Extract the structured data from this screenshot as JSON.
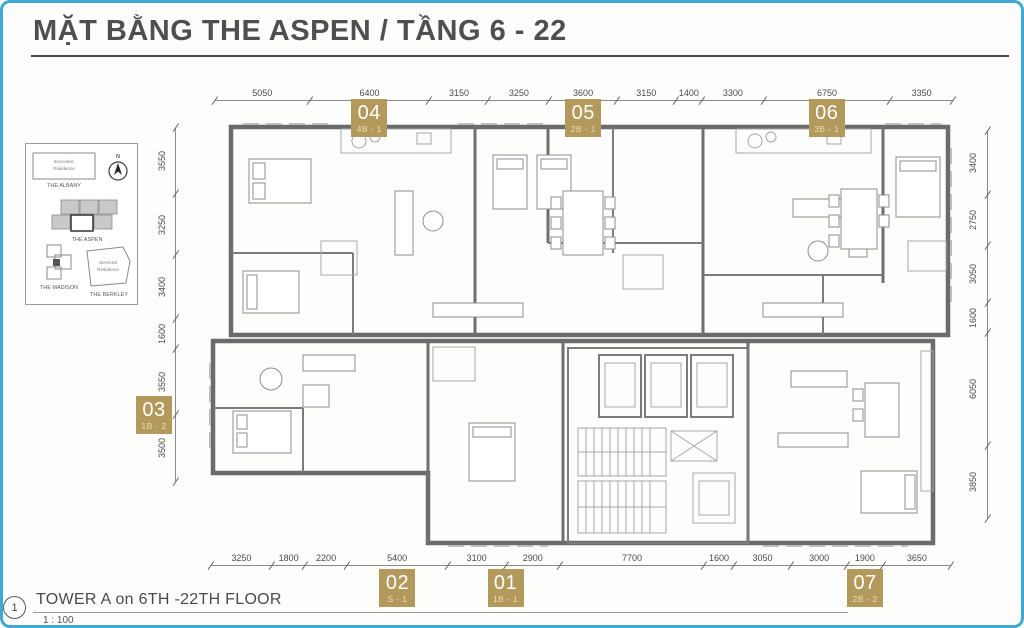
{
  "page": {
    "title": "MẶT BẰNG THE ASPEN / TẦNG 6 - 22",
    "border_color": "#3fa9d5",
    "accent_gold": "#b3995b"
  },
  "key_plan": {
    "compass_label": "N",
    "albany_sub1": "Executive",
    "albany_sub2": "Residence",
    "albany": "THE ALBANY",
    "aspen": "THE ASPEN",
    "madison": "THE MADISON",
    "berkley_sub1": "Serviced",
    "berkley_sub2": "Residence",
    "berkley": "THE BERKLEY"
  },
  "dimensions": {
    "top": [
      5050,
      6400,
      3150,
      3250,
      3600,
      3150,
      1400,
      3300,
      6750,
      3350
    ],
    "bottom": [
      3250,
      1800,
      2200,
      5400,
      3100,
      2900,
      7700,
      1600,
      3050,
      3000,
      1900,
      3650
    ],
    "left": [
      3550,
      3250,
      3400,
      1600,
      3550,
      3500
    ],
    "right": [
      3400,
      2750,
      3050,
      1600,
      6050,
      3850
    ]
  },
  "units": [
    {
      "number": "04",
      "type": "4B - 1",
      "side": "top",
      "pos": 0.209
    },
    {
      "number": "05",
      "type": "2B - 1",
      "side": "top",
      "pos": 0.499
    },
    {
      "number": "06",
      "type": "3B - 1",
      "side": "top",
      "pos": 0.829
    },
    {
      "number": "03",
      "type": "1B - 2",
      "side": "left",
      "pos": 0.814
    },
    {
      "number": "02",
      "type": "S - 1",
      "side": "bottom",
      "pos": 0.252
    },
    {
      "number": "01",
      "type": "1B - 1",
      "side": "bottom",
      "pos": 0.398
    },
    {
      "number": "07",
      "type": "2B - 2",
      "side": "bottom",
      "pos": 0.884
    }
  ],
  "footer": {
    "callout_number": "1",
    "label": "TOWER A on 6TH -22TH FLOOR",
    "scale": "1 : 100"
  }
}
